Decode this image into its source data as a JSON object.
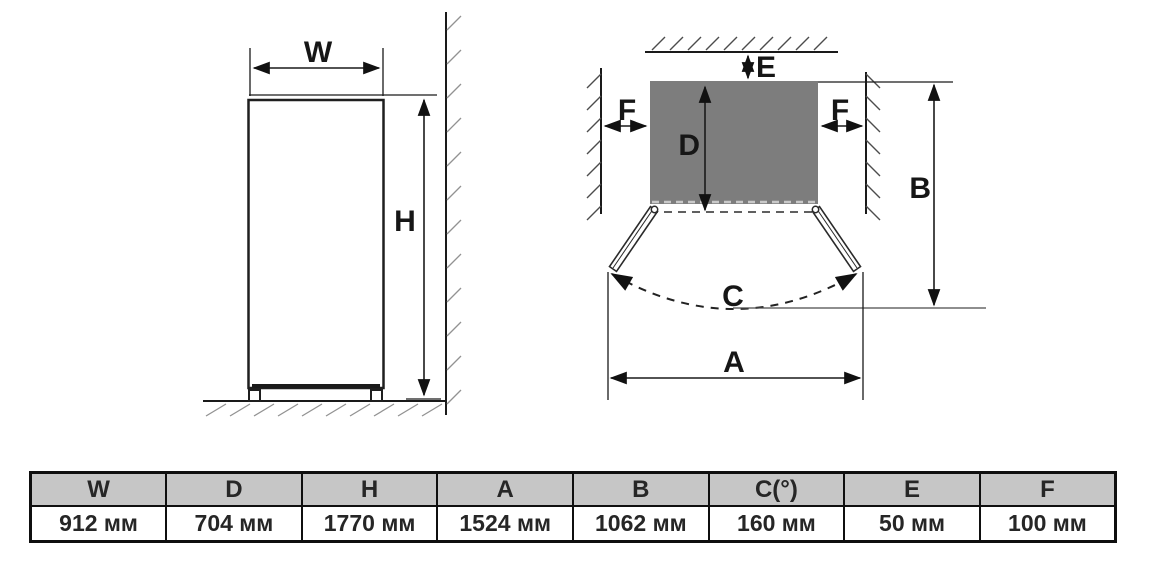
{
  "front_view": {
    "w_label": "W",
    "h_label": "H"
  },
  "top_view": {
    "e_label": "E",
    "f_left_label": "F",
    "f_right_label": "F",
    "d_label": "D",
    "b_label": "B",
    "c_label": "C",
    "a_label": "A"
  },
  "table": {
    "columns": [
      {
        "label": "W",
        "value": "912 мм"
      },
      {
        "label": "D",
        "value": "704 мм"
      },
      {
        "label": "H",
        "value": "1770 мм"
      },
      {
        "label": "A",
        "value": "1524 мм"
      },
      {
        "label": "B",
        "value": "1062 мм"
      },
      {
        "label": "C(°)",
        "value": "160 мм"
      },
      {
        "label": "E",
        "value": "50 мм"
      },
      {
        "label": "F",
        "value": "100 мм"
      }
    ]
  },
  "colors": {
    "cabinet_fill": "#7d7d7d",
    "table_header_bg": "#c6c6c6",
    "line": "#1a1a1a"
  }
}
